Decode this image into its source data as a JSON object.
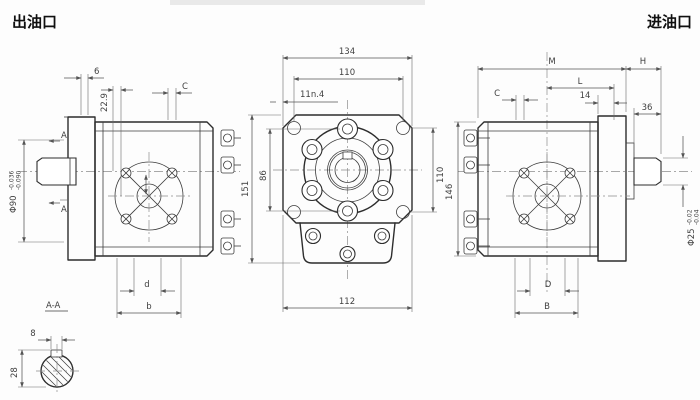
{
  "titles": {
    "outlet": "出油口",
    "inlet": "进油口"
  },
  "left_view": {
    "dim_step": "6",
    "dim_height": "22.9",
    "dim_c": "C",
    "marker_a_top": "A",
    "marker_a_bottom": "A",
    "pilot_dia": "Φ90",
    "pilot_dia_tol_upper": "-0.036",
    "pilot_dia_tol_lower": "-0.090",
    "dim_d": "d",
    "dim_b": "b"
  },
  "front_view": {
    "dim_width_overall": "134",
    "dim_hole_span": "110",
    "dim_offset": "11n.4",
    "dim_height_overall": "151",
    "dim_boss_span": "86",
    "dim_hole_span_vertical": "110",
    "dim_base_width": "112"
  },
  "right_view": {
    "dim_m": "M",
    "dim_h": "H",
    "dim_l": "L",
    "dim_14": "14",
    "dim_c": "C",
    "dim_36": "36",
    "dim_height": "146",
    "shaft_dia": "Φ25",
    "shaft_dia_tol_upper": "-0.02",
    "shaft_dia_tol_lower": "-0.04",
    "dim_d": "D",
    "dim_b": "B"
  },
  "section_aa": {
    "label": "A-A",
    "dim_key_width": "8",
    "dim_height": "28"
  }
}
